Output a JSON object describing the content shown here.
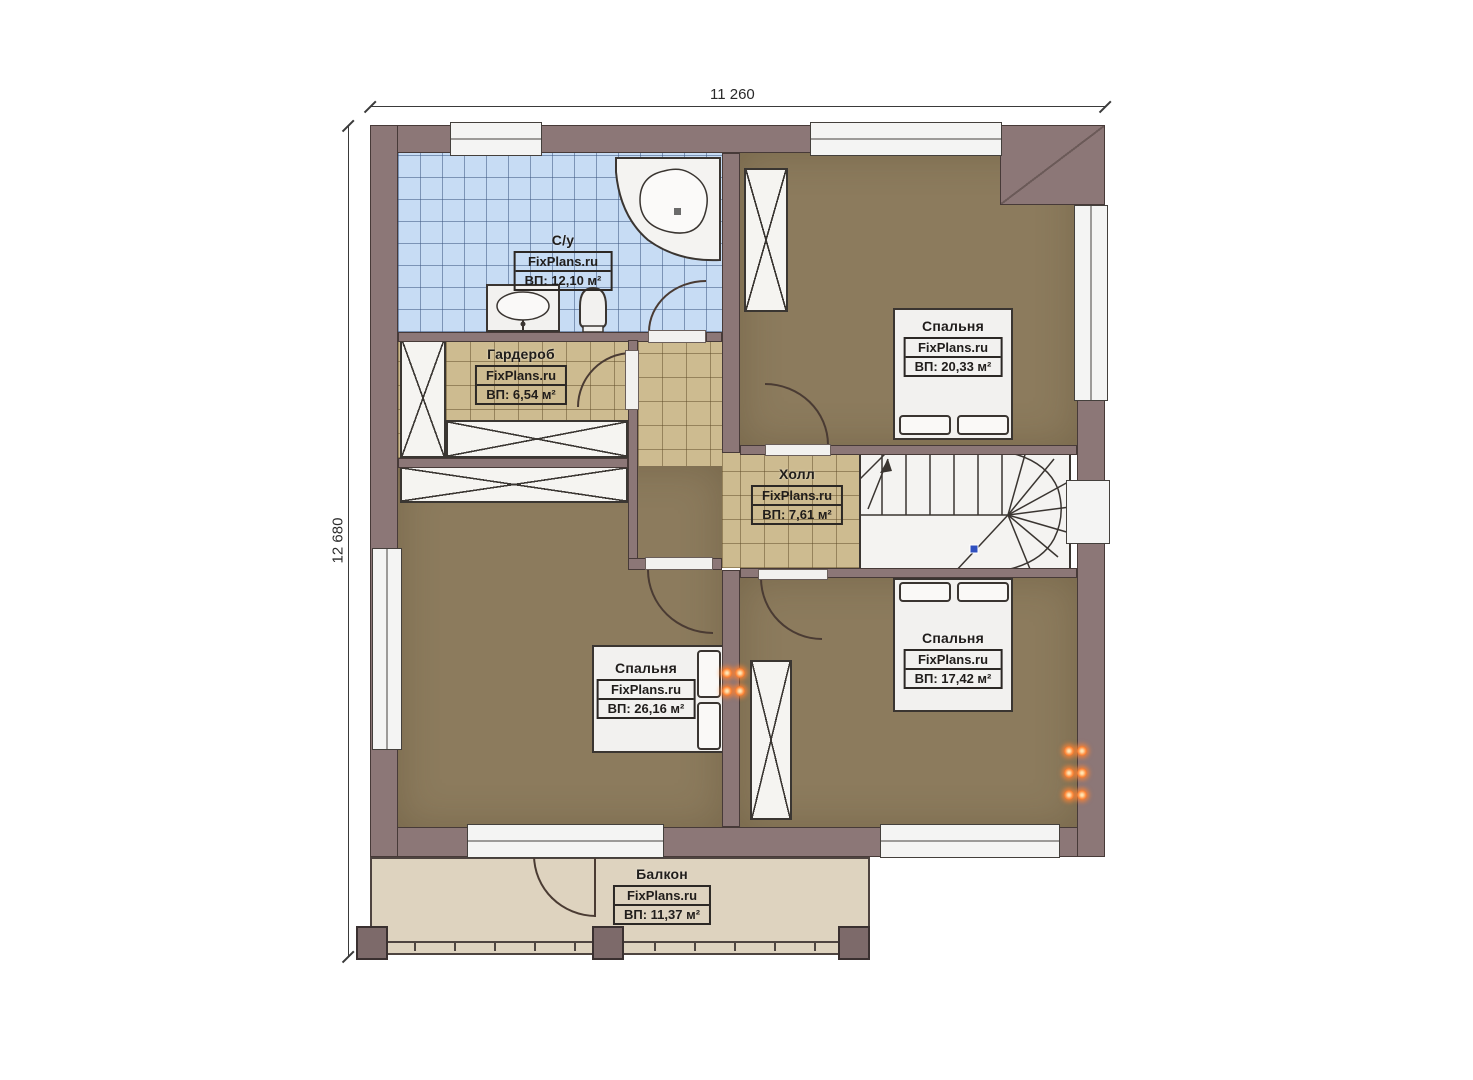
{
  "plan": {
    "site_watermark": "FixPlans.ru",
    "dimensions": {
      "top": "11 260",
      "left": "12 680"
    }
  },
  "rooms": [
    {
      "id": "bathroom",
      "name": "С/у",
      "brand": "FixPlans.ru",
      "area": "ВП: 12,10 м²"
    },
    {
      "id": "wardrobe",
      "name": "Гардероб",
      "brand": "FixPlans.ru",
      "area": "ВП: 6,54 м²"
    },
    {
      "id": "hall",
      "name": "Холл",
      "brand": "FixPlans.ru",
      "area": "ВП: 7,61 м²"
    },
    {
      "id": "bedroom_top_right",
      "name": "Спальня",
      "brand": "FixPlans.ru",
      "area": "ВП: 20,33 м²"
    },
    {
      "id": "bedroom_bottom_left",
      "name": "Спальня",
      "brand": "FixPlans.ru",
      "area": "ВП: 26,16 м²"
    },
    {
      "id": "bedroom_bottom_right",
      "name": "Спальня",
      "brand": "FixPlans.ru",
      "area": "ВП: 17,42 м²"
    },
    {
      "id": "balcony",
      "name": "Балкон",
      "brand": "FixPlans.ru",
      "area": "ВП: 11,37 м²"
    }
  ],
  "colors": {
    "wall": "#8c7777",
    "bathroom_tile": "#c7dcf4",
    "hall_tile": "#cdbb90",
    "bedroom_floor": "#8c7b5d",
    "balcony_floor": "#ded3bf",
    "socket_glow": "#ff8a3c",
    "stair_marker": "#2f4fbf"
  }
}
